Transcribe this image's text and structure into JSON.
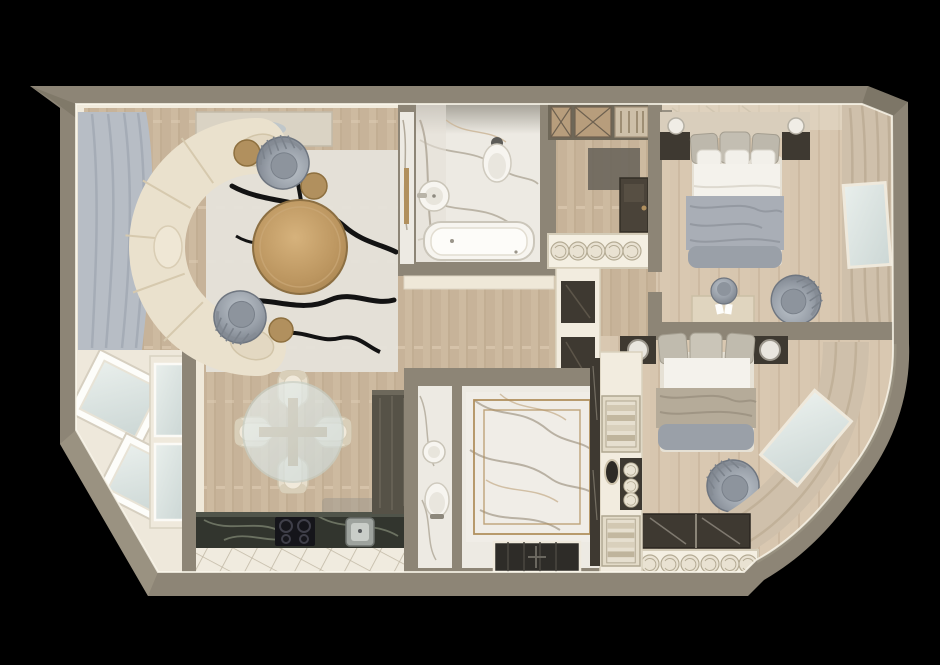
{
  "scene": {
    "type": "3d-floor-plan-render",
    "view": "top-down",
    "description": "Photorealistic top-down 3D render of an apartment floor plan on a black background, with a curved right exterior wall and an angled balcony corner at lower left"
  },
  "palette": {
    "background": "#000000",
    "wall": "#8d8576",
    "wall_dark": "#6e6758",
    "wall_light": "#a59d8b",
    "trim": "#f1ebdd",
    "wood": "#cdbaa0",
    "wood_dark": "#b9a489",
    "wood_light": "#ddccb4",
    "bedroom_floor": "#d7c6af",
    "marble": "#edeae3",
    "marble_vein": "#b2aa9b",
    "marble_warm": "#c9b394",
    "dark_marble": "#32352e",
    "dark_marble_vein": "#79816e",
    "tile": "#f0ebdf",
    "tile_line": "#c2b9a6",
    "sofa": "#eae1cd",
    "sofa_seam": "#d6c9ae",
    "gray_chair": "#99a0a9",
    "gray_chair_dark": "#7b828b",
    "rug": "#e5e2da",
    "rug_vein": "#131313",
    "gold": "#b1905e",
    "blanket_gray": "#a9aeb6",
    "blanket_taupe": "#b5ab99",
    "curtain_gray": "#b7bdc5",
    "curtain_beige": "#cfc0ab",
    "curtain_stroke": "#b3a188",
    "dark_panel": "#3e3931",
    "door_dark": "#4a4339",
    "glass": "#dfe7e5",
    "white": "#f7f5f0",
    "towel": "#e9e2d2",
    "shelf_wood": "#b79d7c"
  },
  "rooms": [
    {
      "id": "living-room",
      "label": "Living room",
      "furniture": [
        "curved-cream-sofa",
        "round-wood-coffee-table",
        "fluted-gray-armchair-top",
        "fluted-gray-armchair-bottom",
        "gold-side-tables",
        "marble-rug-black-veins",
        "tv-console",
        "gray-window-curtains"
      ]
    },
    {
      "id": "dining-area",
      "label": "Dining area",
      "furniture": [
        "round-glass-table",
        "four-cream-chairs",
        "gray-floor-rug"
      ]
    },
    {
      "id": "kitchen",
      "label": "Kitchen",
      "furniture": [
        "dark-marble-counter",
        "cooktop",
        "square-sink",
        "tall-dark-cabinet",
        "diagonal-tile-floor",
        "x-front-cabinet"
      ]
    },
    {
      "id": "bathroom-main",
      "label": "Main bathroom",
      "furniture": [
        "bathtub",
        "wall-hung-toilet",
        "round-sink",
        "marble-tile-walls",
        "gold-towel-rail"
      ]
    },
    {
      "id": "entry-hall",
      "label": "Entry hall",
      "furniture": [
        "entrance-door",
        "x-front-closets",
        "display-cabinet",
        "shoe-shelf-with-rolls",
        "dark-mat"
      ]
    },
    {
      "id": "bedroom-1",
      "label": "Bedroom 1",
      "furniture": [
        "double-bed-gray-blanket",
        "dark-nightstands",
        "wall-sconces",
        "desk",
        "desk-chair",
        "fluted-gray-armchair",
        "beige-curtains-with-window",
        "mirror-wardrobe-strip"
      ]
    },
    {
      "id": "bedroom-2",
      "label": "Bedroom 2",
      "furniture": [
        "double-bed-taupe-blanket",
        "dark-nightstands-with-lamps",
        "fluted-gray-armchair",
        "curved-curtain-wall-with-window",
        "sliding-glass-wardrobe",
        "towel-roll-shelf"
      ]
    },
    {
      "id": "shower-room",
      "label": "Shower room",
      "furniture": [
        "large-marble-panel",
        "double-gold-frame",
        "dark-shower-tray"
      ]
    },
    {
      "id": "guest-wc",
      "label": "Guest WC",
      "furniture": [
        "toilet",
        "small-sink"
      ]
    },
    {
      "id": "storage-column",
      "label": "Storage column",
      "furniture": [
        "towel-stack-cubbies",
        "round-mirror",
        "dark-glass-band"
      ]
    },
    {
      "id": "balcony",
      "label": "Balcony",
      "furniture": [
        "angled-white-windows",
        "glass-partition"
      ]
    }
  ]
}
